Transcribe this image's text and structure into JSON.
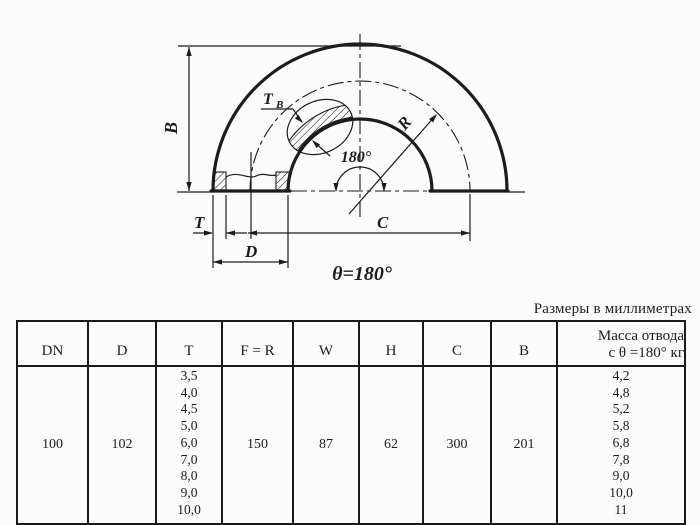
{
  "note": "Размеры в миллиметрах",
  "drawing": {
    "dim_b": "B",
    "dim_tb_main": "T",
    "dim_tb_sub": "B",
    "dim_r": "R",
    "angle_label": "180°",
    "dim_t": "T",
    "dim_d": "D",
    "dim_c": "C",
    "theta_label": "θ=180°"
  },
  "table": {
    "headers": [
      "DN",
      "D",
      "T",
      "F = R",
      "W",
      "H",
      "C",
      "B"
    ],
    "mass_header": {
      "line1": "Масса отвода",
      "line2": "с θ =180° кг"
    },
    "row": {
      "dn": "100",
      "d": "102",
      "t_values": [
        "3,5",
        "4,0",
        "4,5",
        "5,0",
        "6,0",
        "7,0",
        "8,0",
        "9,0",
        "10,0"
      ],
      "f_r": "150",
      "w": "87",
      "h": "62",
      "c": "300",
      "b": "201",
      "mass_values": [
        "4,2",
        "4,8",
        "5,2",
        "5,8",
        "6,8",
        "7,8",
        "9,0",
        "10,0",
        "11"
      ]
    }
  },
  "colors": {
    "ink": "#1c1c1c",
    "background": "#fcfcfc"
  }
}
